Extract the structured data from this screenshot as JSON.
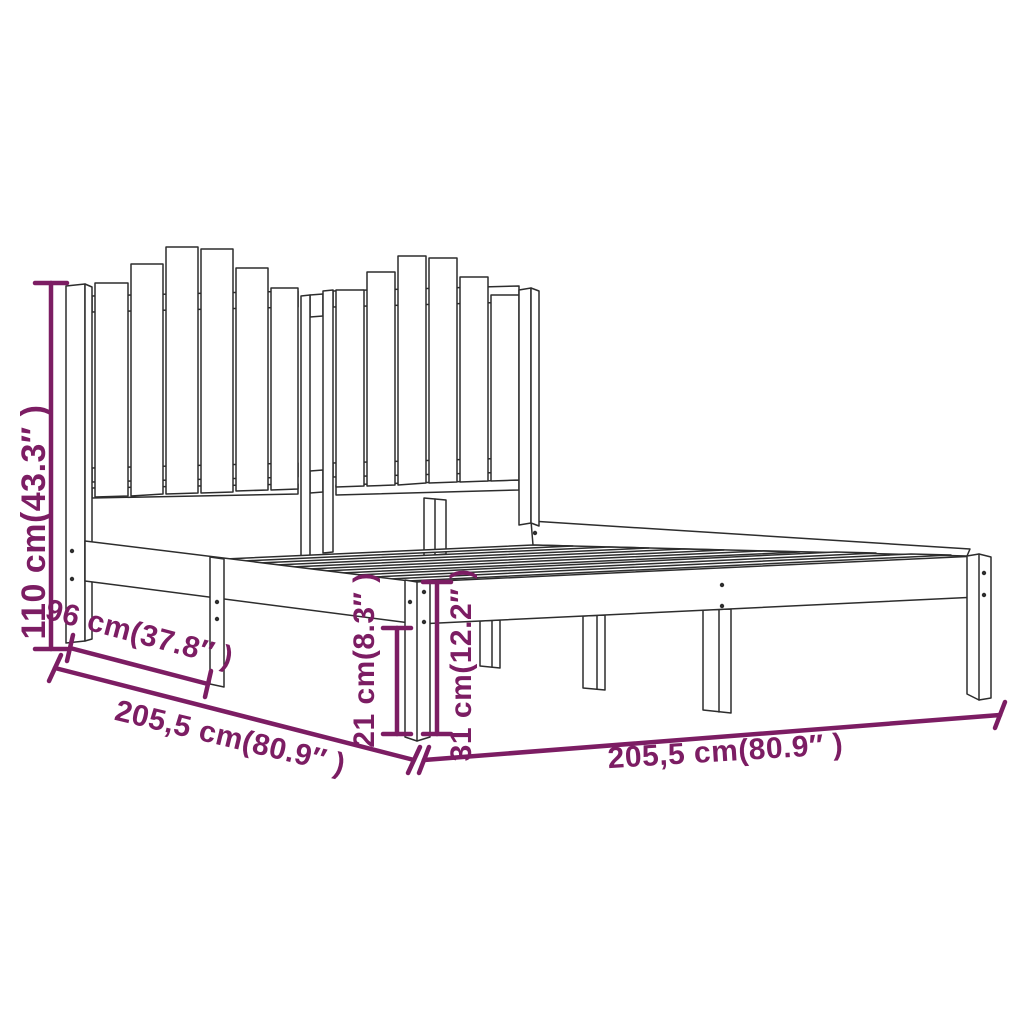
{
  "diagram": {
    "kind": "product-dimension-diagram",
    "subject": "wooden bed frame with slatted picket-style headboard, 3D line drawing",
    "background_color": "#ffffff",
    "outline_color": "#2d2d2d",
    "dimension_color": "#7c1d63",
    "dimensions": {
      "headboard_height": {
        "label": "110 cm(43.3″ )",
        "cm": "110",
        "inches": "43.3",
        "orientation": "vertical-left"
      },
      "side_section": {
        "label": "96 cm(37.8″ )",
        "cm": "96",
        "inches": "37.8",
        "orientation": "diagonal-left-side"
      },
      "side_length": {
        "label": "205,5 cm(80.9″ )",
        "cm": "205,5",
        "inches": "80.9",
        "orientation": "diagonal-left-side"
      },
      "leg_clearance": {
        "label": "21 cm(8.3″ )",
        "cm": "21",
        "inches": "8.3",
        "orientation": "vertical-center"
      },
      "base_height": {
        "label": "31 cm(12.2″ )",
        "cm": "31",
        "inches": "12.2",
        "orientation": "vertical-center"
      },
      "front_length": {
        "label": "205,5 cm(80.9″ )",
        "cm": "205,5",
        "inches": "80.9",
        "orientation": "diagonal-bottom-right"
      }
    }
  }
}
